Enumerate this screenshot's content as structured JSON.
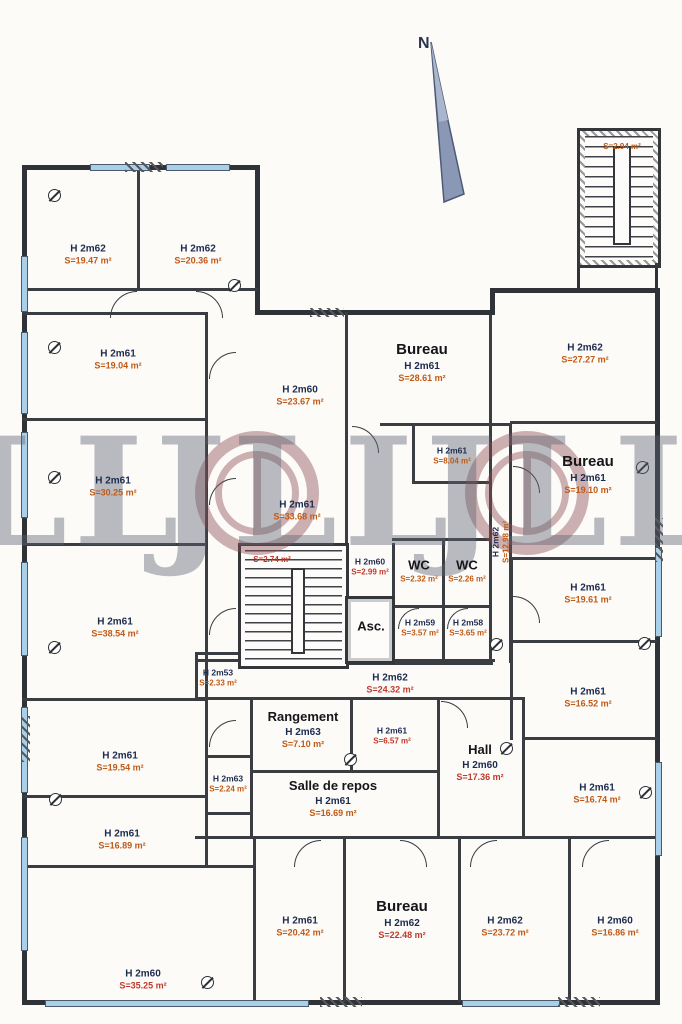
{
  "theme": {
    "wall_color": "#33363b",
    "window_color": "#a9d0e8",
    "h_label_color": "#1d2b4f",
    "s_label_color": "#c05a17",
    "s_label_alt_color": "#c03a2b",
    "watermark_gray": "#5d6372",
    "watermark_red": "#8c4a50",
    "compass_color": "#8a98b6"
  },
  "compass": {
    "label": "N"
  },
  "watermark": {
    "letters": "JLL"
  },
  "stair_top_right": {
    "s": "S=2.94 m²"
  },
  "elevator": {
    "label": "Asc."
  },
  "rooms": [
    {
      "h": "H 2m62",
      "s": "S=19.47 m²"
    },
    {
      "h": "H 2m62",
      "s": "S=20.36 m²"
    },
    {
      "h": "H 2m61",
      "s": "S=19.04 m²"
    },
    {
      "h": "H 2m61",
      "s": "S=30.25 m²"
    },
    {
      "h": "H 2m61",
      "s": "S=38.54 m²"
    },
    {
      "h": "H 2m61",
      "s": "S=19.54 m²"
    },
    {
      "h": "H 2m61",
      "s": "S=16.89 m²"
    },
    {
      "h": "H 2m60",
      "s": "S=35.25 m²"
    },
    {
      "h": "H 2m60",
      "s": "S=23.67 m²"
    },
    {
      "title": "Bureau",
      "h": "H 2m61",
      "s": "S=28.61 m²"
    },
    {
      "h": "H 2m61",
      "s": "S=8.04 m²"
    },
    {
      "h": "H 2m62",
      "s": "S=12.98 m²"
    },
    {
      "title": "Bureau",
      "h": "H 2m61",
      "s": "S=19.10 m²"
    },
    {
      "h": "H 2m62",
      "s": "S=27.27 m²"
    },
    {
      "h": "H 2m61",
      "s": "S=19.61 m²"
    },
    {
      "h": "H 2m61",
      "s": "S=16.52 m²"
    },
    {
      "h": "H 2m61",
      "s": "S=16.74 m²"
    },
    {
      "h": "H 2m61",
      "s": "S=33.68 m²"
    },
    {
      "s": "S=2.74 m²"
    },
    {
      "h": "H 2m60",
      "s": "S=2.99 m²"
    },
    {
      "title": "WC",
      "s": "S=2.32 m²"
    },
    {
      "title": "WC",
      "s": "S=2.26 m²"
    },
    {
      "h": "H 2m59",
      "s": "S=3.57 m²"
    },
    {
      "h": "H 2m58",
      "s": "S=3.65 m²"
    },
    {
      "h": "H 2m53",
      "s": "S=2.33 m²"
    },
    {
      "h": "H 2m62",
      "s": "S=24.32 m²"
    },
    {
      "title": "Rangement",
      "h": "H 2m63",
      "s": "S=7.10 m²"
    },
    {
      "h": "H 2m61",
      "s": "S=6.57 m²"
    },
    {
      "title": "Hall",
      "h": "H 2m60",
      "s": "S=17.36 m²"
    },
    {
      "title": "Salle de repos",
      "h": "H 2m61",
      "s": "S=16.69 m²"
    },
    {
      "h": "H 2m63",
      "s": "S=2.24 m²"
    },
    {
      "h": "H 2m61",
      "s": "S=20.42 m²"
    },
    {
      "title": "Bureau",
      "h": "H 2m62",
      "s": "S=22.48 m²"
    },
    {
      "h": "H 2m62",
      "s": "S=23.72 m²"
    },
    {
      "h": "H 2m60",
      "s": "S=16.86 m²"
    }
  ]
}
